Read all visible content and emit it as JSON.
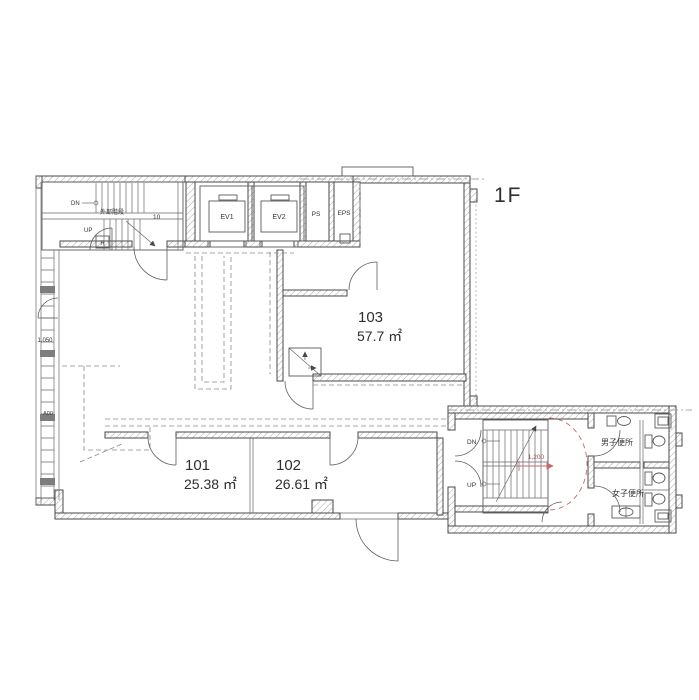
{
  "floor_label": "1F",
  "rooms": [
    {
      "number": "101",
      "area": "25.38 ㎡"
    },
    {
      "number": "102",
      "area": "26.61 ㎡"
    },
    {
      "number": "103",
      "area": "57.7 ㎡"
    }
  ],
  "core": {
    "ev1": "EV1",
    "ev2": "EV2",
    "ps": "PS",
    "eps": "EPS"
  },
  "external_stair": {
    "name": "外部階段",
    "dn": "DN",
    "up": "UP",
    "steps": "10",
    "mark": "R"
  },
  "internal_stair": {
    "dn": "DN",
    "up": "UP",
    "radius_dim": "1,200"
  },
  "toilets": {
    "mens": "男子便所",
    "womens": "女子便所"
  },
  "annotations": {
    "left_dim": "1,050",
    "left_mark": "A00"
  },
  "colors": {
    "wall_line": "#4a4a4a",
    "thin_line": "#6a6a6a",
    "dashed_line": "#8a8a8a",
    "accent_red": "#c46a6a",
    "text": "#333333"
  }
}
